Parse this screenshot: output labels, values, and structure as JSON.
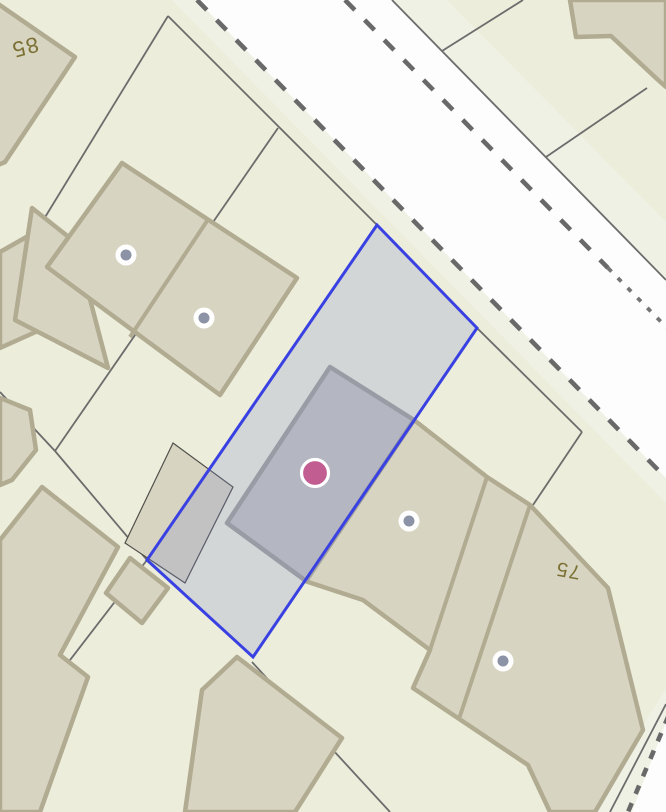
{
  "map": {
    "kind": "cadastral-parcel-map",
    "labels": {
      "house_85": "85",
      "house_75": "75"
    },
    "label_transforms": {
      "house_85": "translate(23,40) rotate(165)",
      "house_75": "translate(569,564) rotate(190)"
    },
    "label_sizes": {
      "house_85": "22",
      "house_75": "20"
    },
    "colors": {
      "background": "#ecedda",
      "road_fill": "#fdfdfd",
      "road_shoulder": "#f0f1e5",
      "lot_line": "#6c6c6c",
      "dash_line": "#696969",
      "building_fill": "#d8d4c2",
      "building_stroke": "#b1ab92",
      "selected_building_fill": "#c6c5c0",
      "selection_fill": "rgba(120,130,200,0.22)",
      "selection_stroke": "#3a41e2",
      "address_label": "#7b7034",
      "marker_ring": "#ffffff",
      "marker_dot": "#8d93a6",
      "poi_fill": "#c25d92"
    },
    "markers": {
      "address_1": {
        "x": "126",
        "y": "255"
      },
      "address_2": {
        "x": "204",
        "y": "318"
      },
      "address_3": {
        "x": "409",
        "y": "521"
      },
      "address_4": {
        "x": "503",
        "y": "661"
      },
      "selected_poi": {
        "x": "315",
        "y": "473"
      }
    }
  }
}
